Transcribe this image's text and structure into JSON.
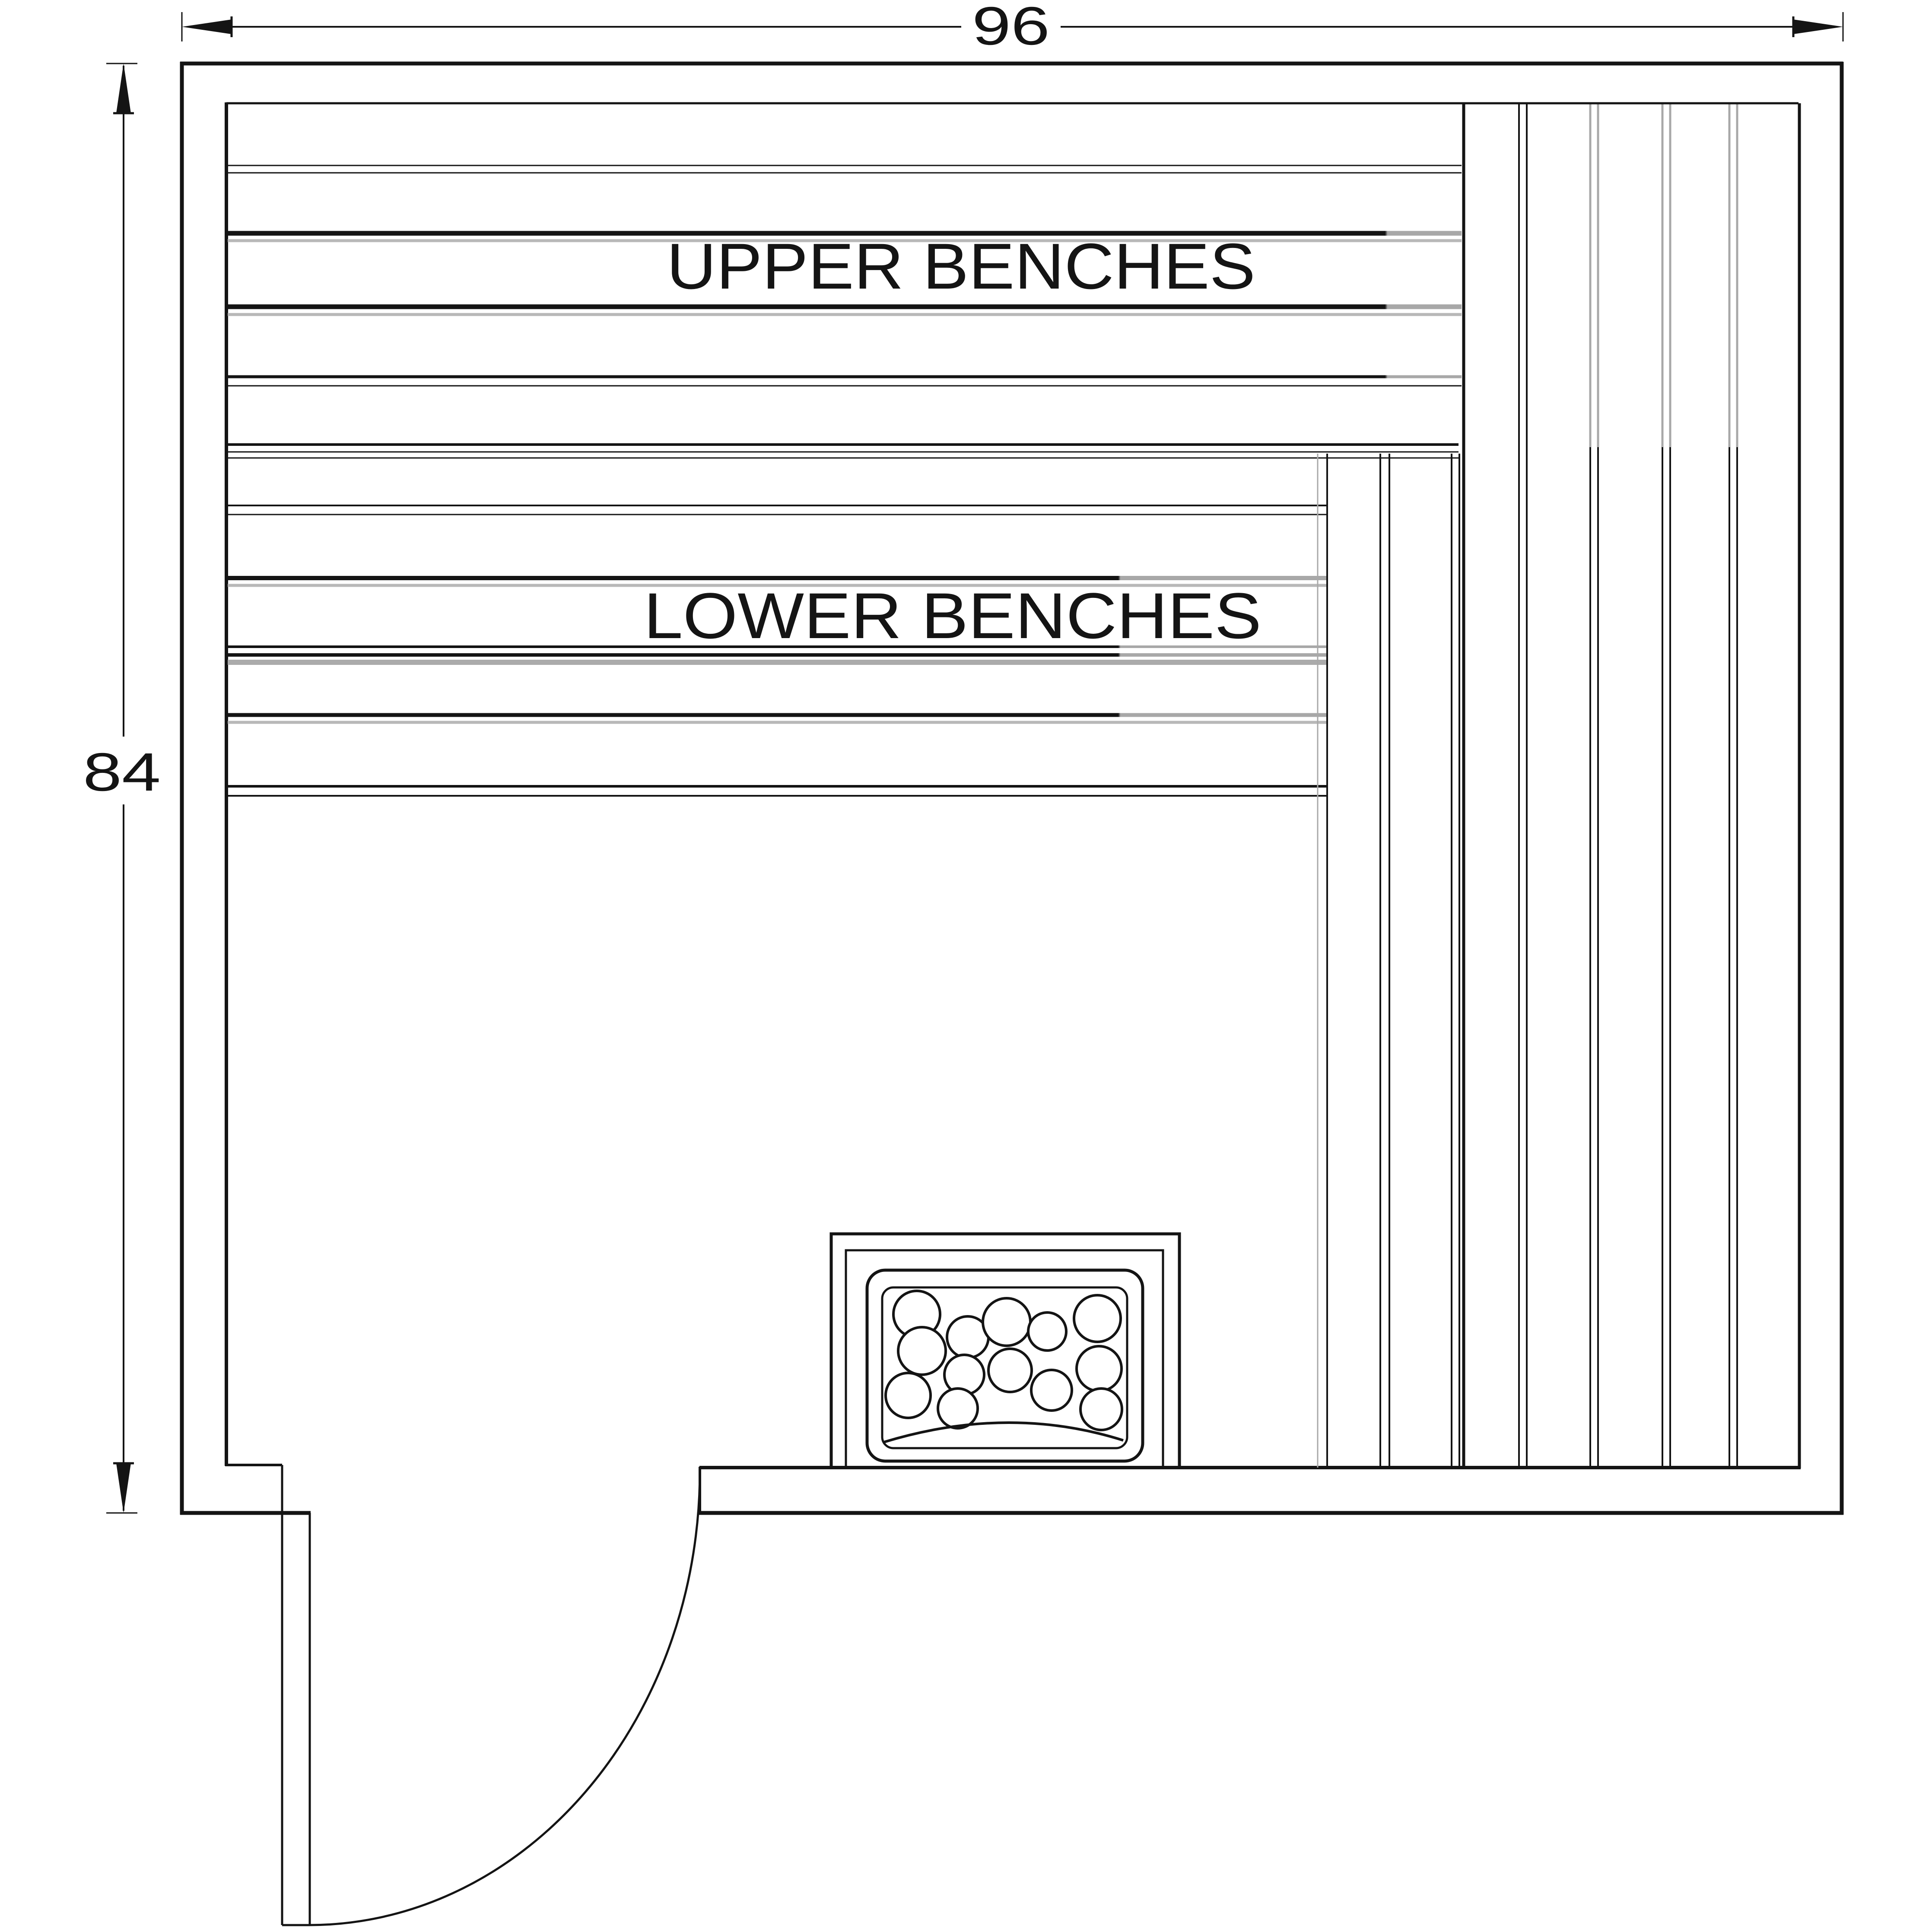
{
  "plan": {
    "background_color": "#ffffff",
    "line_color": "#141414",
    "hidden_line_color": "#a8a8a8",
    "width_dimension": "96",
    "height_dimension": "84",
    "upper_bench_label": "UPPER BENCHES",
    "lower_bench_label": "LOWER BENCHES"
  }
}
